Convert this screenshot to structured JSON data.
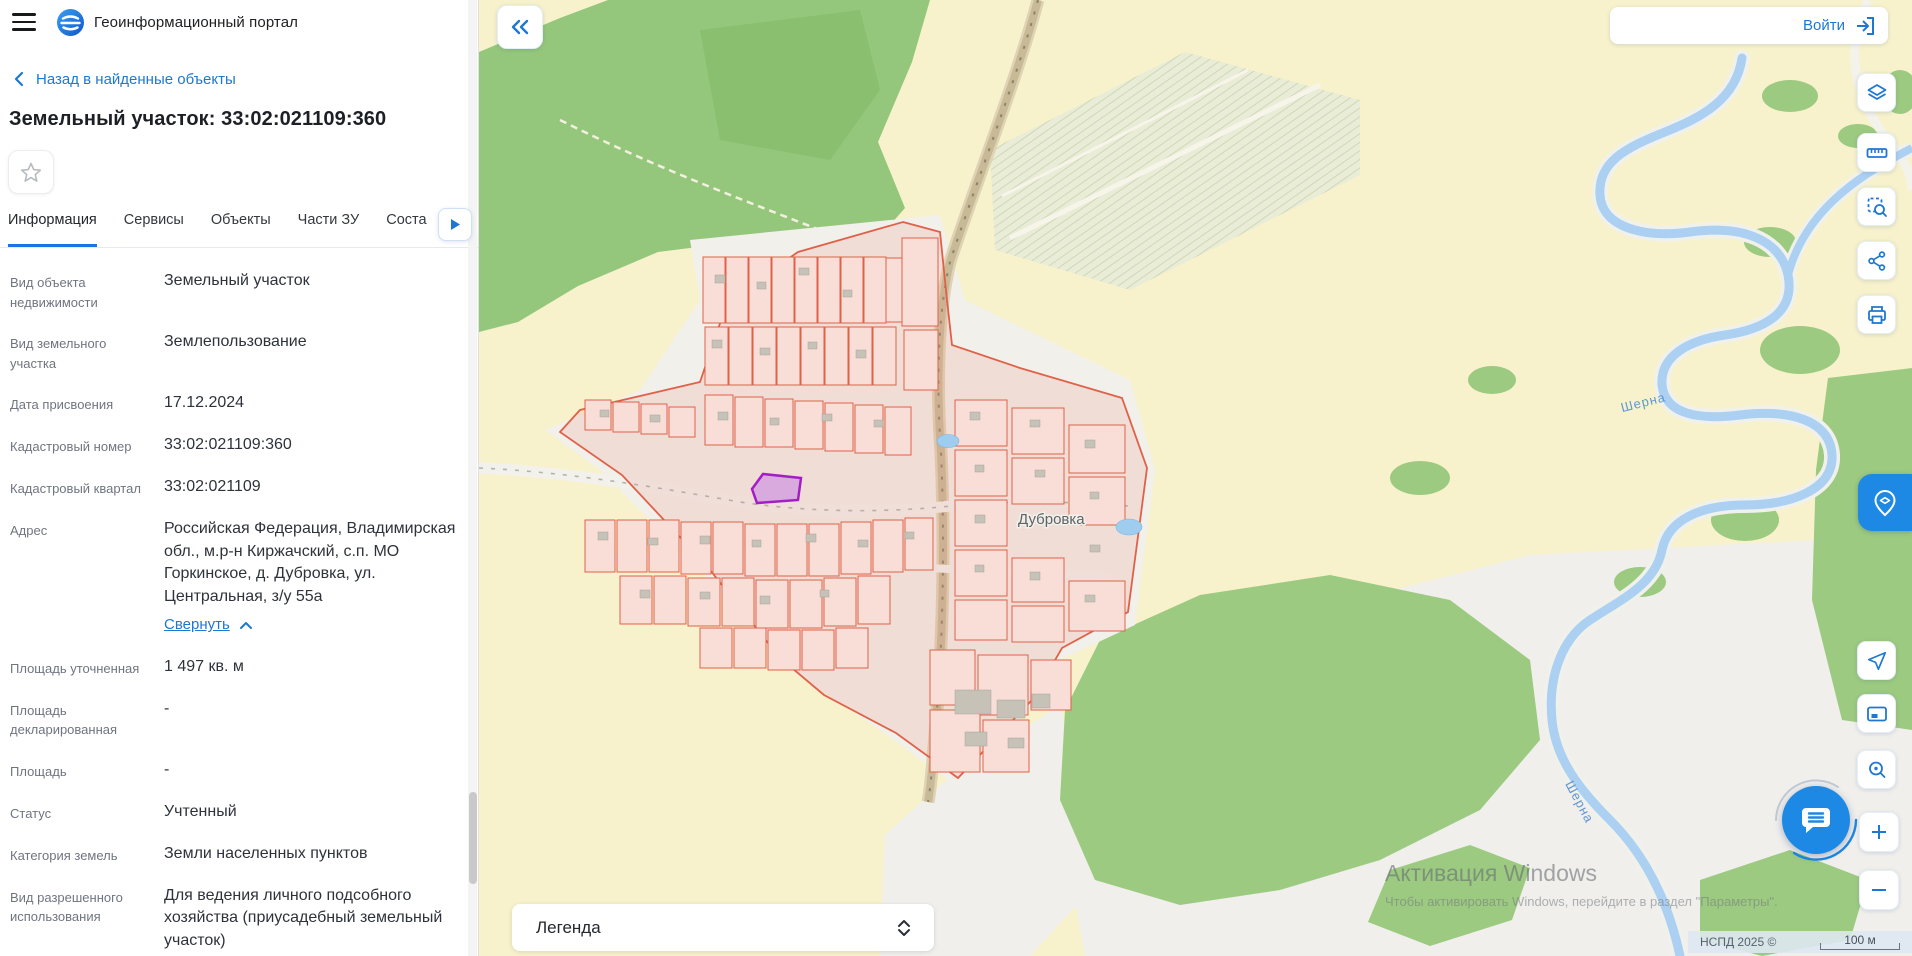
{
  "header": {
    "app_title": "Геоинформационный портал"
  },
  "topbar": {
    "login": "Войти"
  },
  "sidebar": {
    "back": "Назад в найденные объекты",
    "title": "Земельный участок: 33:02:021109:360",
    "tabs": {
      "t1": "Информация",
      "t2": "Сервисы",
      "t3": "Объекты",
      "t4": "Части ЗУ",
      "t5": "Соста"
    },
    "address_toggle": "Свернуть",
    "fields": [
      {
        "label": "Вид объекта недвижимости",
        "value": "Земельный участок"
      },
      {
        "label": "Вид земельного участка",
        "value": "Землепользование"
      },
      {
        "label": "Дата присвоения",
        "value": "17.12.2024"
      },
      {
        "label": "Кадастровый номер",
        "value": "33:02:021109:360"
      },
      {
        "label": "Кадастровый квартал",
        "value": "33:02:021109"
      },
      {
        "label": "Адрес",
        "value": "Российская Федерация, Владимирская обл., м.р-н Киржачский, с.п. МО Горкинское, д. Дубровка, ул. Центральная, з/у 55а"
      },
      {
        "label": "Площадь уточненная",
        "value": "1 497 кв. м"
      },
      {
        "label": "Площадь декларированная",
        "value": "-"
      },
      {
        "label": "Площадь",
        "value": "-"
      },
      {
        "label": "Статус",
        "value": "Учтенный"
      },
      {
        "label": "Категория земель",
        "value": "Земли населенных пунктов"
      },
      {
        "label": "Вид разрешенного использования",
        "value": "Для ведения личного подсобного хозяйства (приусадебный земельный участок)"
      }
    ]
  },
  "map": {
    "settlement_label": "Дубровка",
    "river_label": "Шерна",
    "legend_title": "Легенда",
    "attribution": "НСПД 2025 ©",
    "scale": "100 м",
    "watermark_line1": "Активация Windows",
    "watermark_line2": "Чтобы активировать Windows, перейдите в раздел \"Параметры\"."
  },
  "colors": {
    "accent": "#1e78d2",
    "selection_border": "#a21fc4",
    "parcel_border": "#e0614a"
  }
}
